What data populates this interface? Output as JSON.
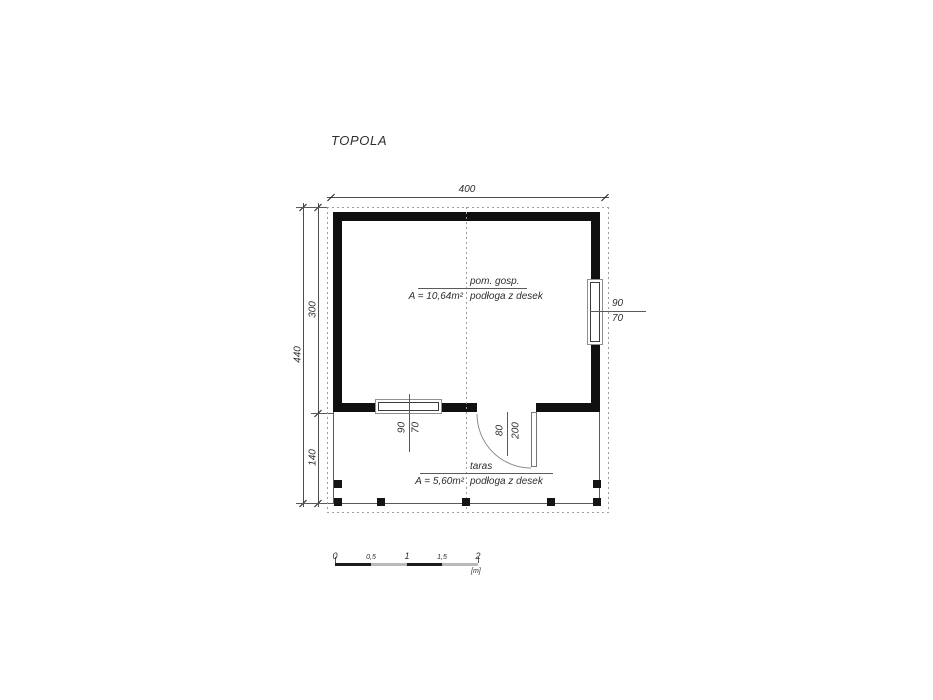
{
  "title": "TOPOLA",
  "dims": {
    "top": "400",
    "left_total": "440",
    "room_height": "300",
    "terrace_height": "140"
  },
  "room": {
    "name": "pom. gosp.",
    "area": "A = 10,64m²",
    "floor": "podłoga z desek"
  },
  "terrace": {
    "name": "taras",
    "area": "A = 5,60m²",
    "floor": "podłoga z desek"
  },
  "openings": {
    "right_window": {
      "w": "90",
      "h": "70"
    },
    "terrace_window": {
      "w": "90",
      "h": "70"
    },
    "door": {
      "w": "80",
      "h": "200"
    }
  },
  "scale_bar": {
    "labels": [
      "0",
      "0,5",
      "1",
      "1,5",
      "2"
    ],
    "unit": "[m]"
  },
  "colors": {
    "wall": "#101010",
    "dash": "#9c9c9c",
    "line": "#4d4d4d",
    "text": "#2e2e2e"
  }
}
